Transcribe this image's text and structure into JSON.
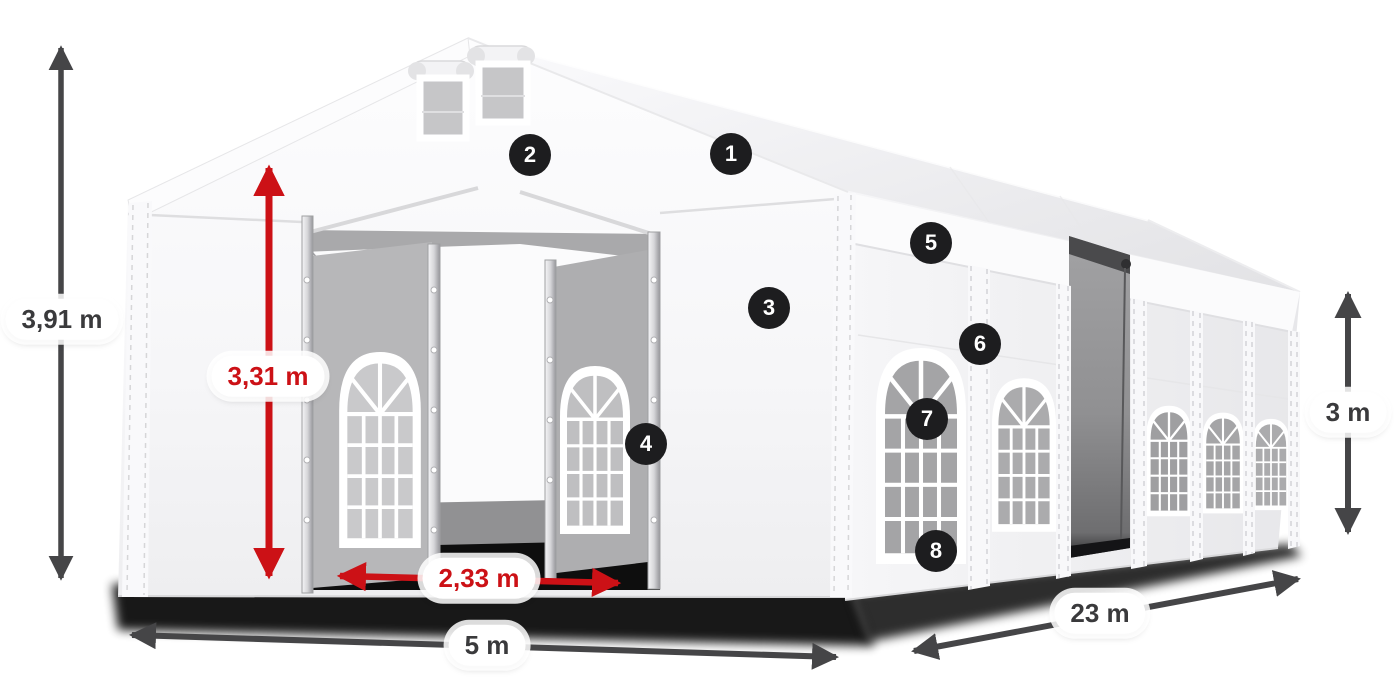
{
  "diagram": {
    "colors": {
      "background": "#ffffff",
      "accent_red": "#cc1116",
      "dim_gray": "#454547",
      "label_text_gray": "#3a3a3c",
      "label_bg": "#ffffff",
      "badge_bg": "#1d1d1f",
      "badge_text": "#ffffff"
    },
    "dimensions": {
      "total_height": {
        "label": "3,91 m"
      },
      "inner_height": {
        "label": "3,31 m"
      },
      "door_width": {
        "label": "2,33 m"
      },
      "front_width": {
        "label": "5 m"
      },
      "side_length": {
        "label": "23 m"
      },
      "wall_height": {
        "label": "3 m"
      }
    },
    "badges": [
      {
        "number": "1"
      },
      {
        "number": "2"
      },
      {
        "number": "3"
      },
      {
        "number": "4"
      },
      {
        "number": "5"
      },
      {
        "number": "6"
      },
      {
        "number": "7"
      },
      {
        "number": "8"
      }
    ]
  }
}
